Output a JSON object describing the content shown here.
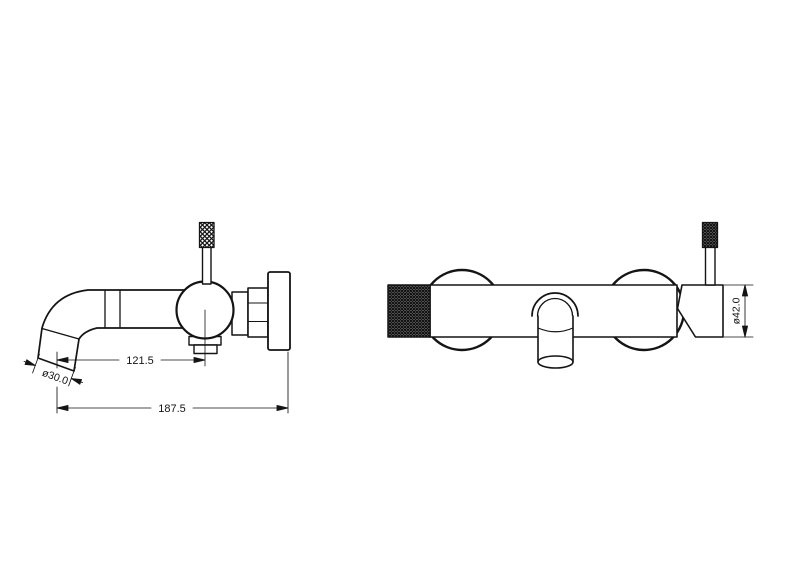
{
  "drawing": {
    "background": "#ffffff",
    "line_color": "#141414",
    "views": [
      {
        "name": "side-view",
        "dimensions": {
          "spout_reach": "121.5",
          "spout_outlet_diameter": "ø30.0",
          "overall_projection": "187.5"
        }
      },
      {
        "name": "front-view",
        "dimensions": {
          "body_diameter": "ø42.0"
        }
      }
    ]
  }
}
